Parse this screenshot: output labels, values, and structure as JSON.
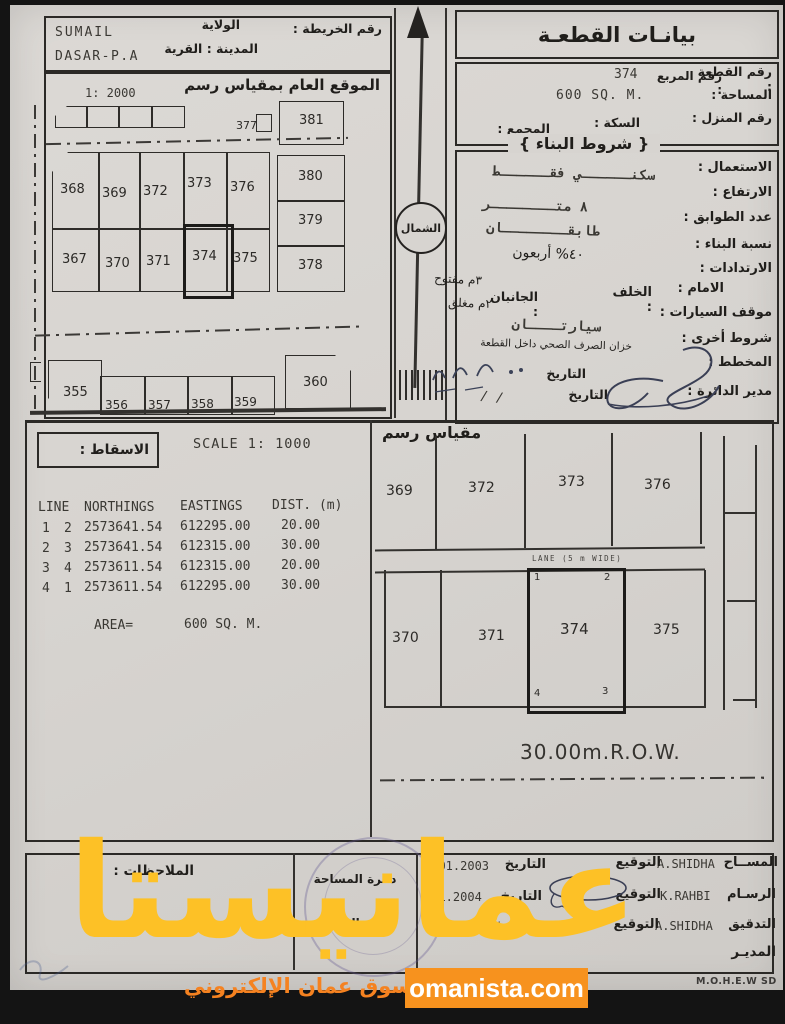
{
  "watermark": {
    "brand": "عمانيستا",
    "tagline": "سوق عمان الإلكتروني",
    "site": "omanista.com",
    "gold": "#fdc126",
    "orange": "#f58220"
  },
  "header": {
    "map_no_label": "رقم الخريطة :",
    "wilaya_label": "الولاية",
    "wilaya_value": "SUMAIL",
    "town_label": "المدينة : القرية",
    "town_value": "DASAR-P.A"
  },
  "overview": {
    "title": "الموقع العام بمقياس رسم",
    "scale": "1: 2000",
    "north": "الشمال",
    "lot_377": "377",
    "row_mid": [
      "368",
      "369",
      "372",
      "373",
      "376"
    ],
    "row_bottom": [
      "367",
      "370",
      "371",
      "374",
      "375"
    ],
    "col_right": [
      "381",
      "380",
      "379",
      "378"
    ],
    "row_street": [
      "355",
      "356",
      "357",
      "358",
      "359",
      "360"
    ]
  },
  "plot": {
    "title": "بيانـات القطعـة",
    "no_label": "رقم القطعة :",
    "no_value": "374",
    "square_label": "رقم المربع :",
    "area_label": "المساحة :",
    "area_value": "600 SQ. M.",
    "house_label": "رقم المنزل :",
    "street_label": "السكة :",
    "complex_label": "المجمع :"
  },
  "building": {
    "header": "{ شروط البناء }",
    "use_label": "الاستعمال :",
    "use_value": "سكنــــــي فقــــــط",
    "height_label": "الارتفاع :",
    "height_value": "٨ متــــــــر",
    "floors_label": "عدد الطوابق :",
    "floors_value": "طابقــــــــان",
    "ratio_label": "نسبة البناء :",
    "ratio_value": "٤٠% أربعون",
    "setback_label": "الارتدادات :",
    "front_label": "الامام :",
    "front_value": "٣م مفتوح",
    "back_label": "الخلف :",
    "sides_label": "الجانبان :",
    "sides_value": "٢م مغلق",
    "parking_label": "موقف السيارات :",
    "parking_value": "سيارتــــان",
    "other_label": "شروط أخرى :",
    "other_value": "خزان الصرف الصحي داخل القطعة",
    "plan_label": "المخطط :",
    "date_label": "التاريخ",
    "director_label": "مدير الدائرة :",
    "date2_label": "التاريخ",
    "date2_value": "/   /"
  },
  "survey": {
    "projection_label": "الاسقاط :",
    "scale_text": "SCALE 1: 1000",
    "drawing_scale_label": "مقياس رسم",
    "table": {
      "h_line": "LINE",
      "h_north": "NORTHINGS",
      "h_east": "EASTINGS",
      "h_dist": "DIST. (m)",
      "rows": [
        [
          "1",
          "2",
          "2573641.54",
          "612295.00",
          "20.00"
        ],
        [
          "2",
          "3",
          "2573641.54",
          "612315.00",
          "30.00"
        ],
        [
          "3",
          "4",
          "2573611.54",
          "612315.00",
          "20.00"
        ],
        [
          "4",
          "1",
          "2573611.54",
          "612295.00",
          "30.00"
        ]
      ],
      "area_label": "AREA=",
      "area_value": "600 SQ. M."
    }
  },
  "detail": {
    "top_plots": [
      "369",
      "372",
      "373",
      "376"
    ],
    "bottom_plots": [
      "370",
      "371",
      "374",
      "375"
    ],
    "lane": "LANE (5 m WIDE)",
    "row_label": "30.00m.R.O.W.",
    "corners": [
      "1",
      "2",
      "3",
      "4"
    ]
  },
  "signoff": {
    "notes_label": "الملاحظات :",
    "stamp_line1": "دائرة المساحة",
    "stamp_line2": "ختم الدائرة",
    "sig_label": "التوقيع",
    "date_label": "التاريخ",
    "rows": [
      {
        "role": "المســاح",
        "name": "A.SHIDHA",
        "date": "5.01.2003"
      },
      {
        "role": "الرسـام",
        "name": "K.RAHBI",
        "date": "4.1.2004"
      },
      {
        "role": "التدقيق",
        "name": "A.SHIDHA",
        "date": "4.1.2004"
      }
    ],
    "director": "المديـر",
    "org_code": "M.O.H.E.W SD"
  }
}
